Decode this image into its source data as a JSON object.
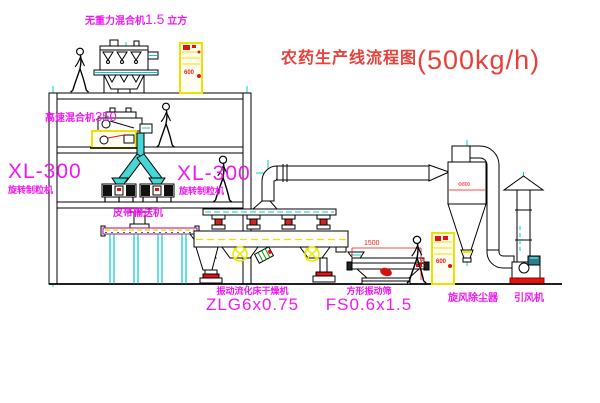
{
  "title": {
    "name": "农药生产线流程图",
    "capacity": "(500kg/h)"
  },
  "equipment": {
    "gravity_mixer": {
      "name": "无重力混合机",
      "size": "1.5",
      "unit": "立方"
    },
    "high_speed_mixer": {
      "name": "高速混合机",
      "size": "350"
    },
    "granulator_left": {
      "model": "XL-300",
      "name": "旋转制粒机"
    },
    "granulator_center": {
      "model": "XL-300",
      "name": "旋转制粒机"
    },
    "belt_conveyor": {
      "name": "皮带输送机"
    },
    "fluid_bed_dryer": {
      "name": "振动流化床干燥机",
      "model": "ZLG6x0.75"
    },
    "vibrating_sieve": {
      "name": "方形振动筛",
      "model": "FS0.6x1.5",
      "dim_width": "1500",
      "dim_height": "541"
    },
    "cyclone": {
      "name": "旋风除尘器",
      "size": "Φ800"
    },
    "fan": {
      "name": "引风机"
    },
    "control_panel_top": {
      "text": "600"
    },
    "control_panel_right": {
      "text": "600"
    }
  },
  "colors": {
    "label_magenta": "#f018f0",
    "title_red": "#e8403a",
    "cad_cyan": "#00cccc",
    "cad_yellow": "#f0df00",
    "cad_red": "#e81111",
    "line_black": "#000000"
  }
}
